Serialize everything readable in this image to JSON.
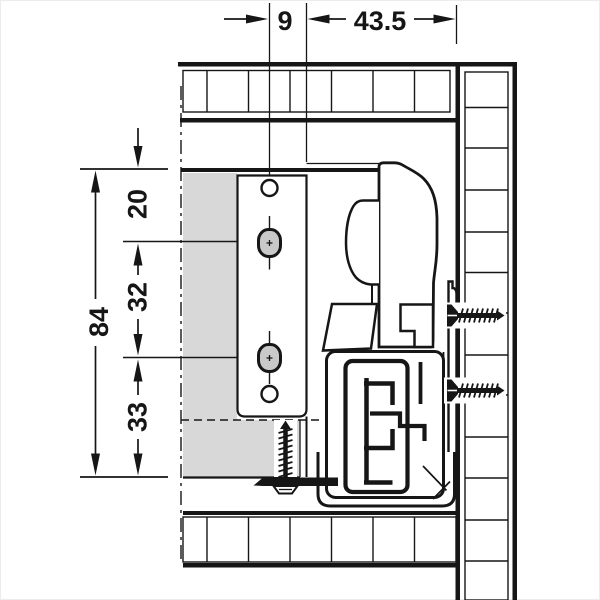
{
  "dimensions": {
    "horizontal": [
      {
        "value": "9"
      },
      {
        "value": "43.5"
      }
    ],
    "vertical": [
      {
        "value": "20"
      },
      {
        "value": "32"
      },
      {
        "value": "33"
      },
      {
        "value": "84"
      }
    ]
  },
  "colors": {
    "line": "#161616",
    "panel": "#d8d8d8",
    "fastener": "#c9c9c9",
    "bg": "#ffffff"
  }
}
